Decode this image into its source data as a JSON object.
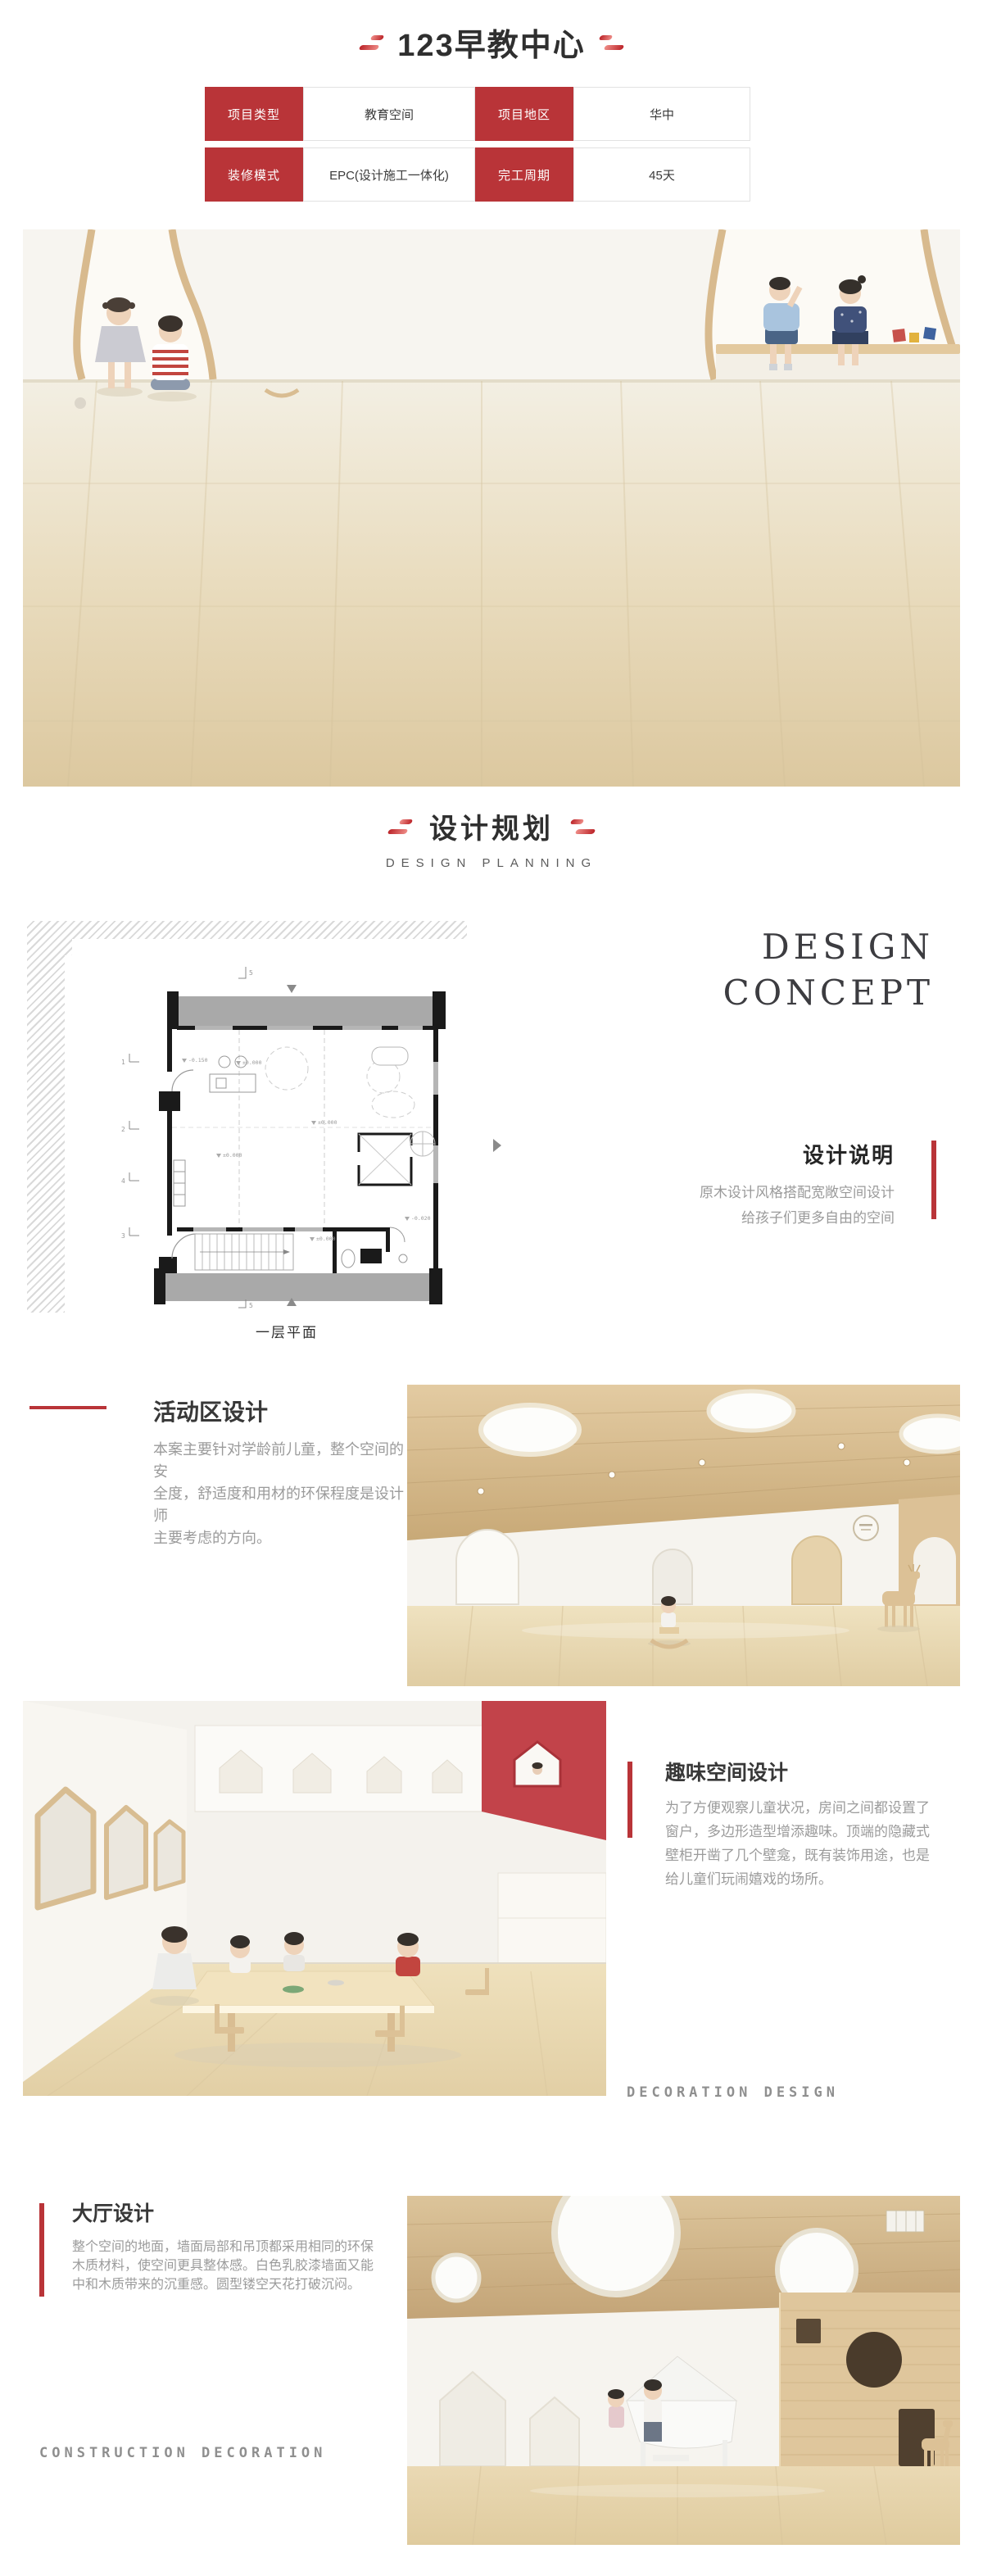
{
  "colors": {
    "accent": "#b93438",
    "title_text": "#2f2f2f",
    "body_gray": "#9b9b9b",
    "watermark_gray": "#8f8f8f"
  },
  "page": {
    "title": "123早教中心"
  },
  "info_table": {
    "rows": [
      [
        "项目类型",
        "教育空间",
        "项目地区",
        "华中"
      ],
      [
        "装修模式",
        "EPC(设计施工一体化)",
        "完工周期",
        "45天"
      ]
    ]
  },
  "planning_header": {
    "title": "设计规划",
    "subtitle": "DESIGN PLANNING"
  },
  "concept": {
    "line1": "DESIGN",
    "line2": "CONCEPT",
    "heading": "设计说明",
    "desc": "原木设计风格搭配宽敞空间设计\n给孩子们更多自由的空间",
    "plan_caption": "一层平面",
    "plan_labels": {
      "g1": "1",
      "g2": "2",
      "g3": "4",
      "g4": "3",
      "g5": "5",
      "g6": "5"
    },
    "plan_annotations": {
      "a1": "-0.150",
      "a2": "±0.000",
      "a3": "±0.000",
      "a4": "±0.000",
      "a5": "±0.000",
      "a6": "-0.020"
    }
  },
  "sections": {
    "activity": {
      "heading": "活动区设计",
      "body": "本案主要针对学龄前儿童，整个空间的安\n全度，舒适度和用材的环保程度是设计师\n主要考虑的方向。"
    },
    "fun": {
      "heading": "趣味空间设计",
      "body": "为了方便观察儿童状况，房间之间都设置了\n窗户，多边形造型增添趣味。顶端的隐藏式\n壁柜开凿了几个壁龛，既有装饰用途，也是\n给儿童们玩闹嬉戏的场所。",
      "watermark": "DECORATION DESIGN"
    },
    "hall": {
      "heading": "大厅设计",
      "body": "整个空间的地面，墙面局部和吊顶都采用相同的环保\n木质材料，使空间更具整体感。白色乳胶漆墙面又能\n中和木质带来的沉重感。圆型镂空天花打破沉闷。",
      "watermark": "CONSTRUCTION DECORATION"
    }
  }
}
